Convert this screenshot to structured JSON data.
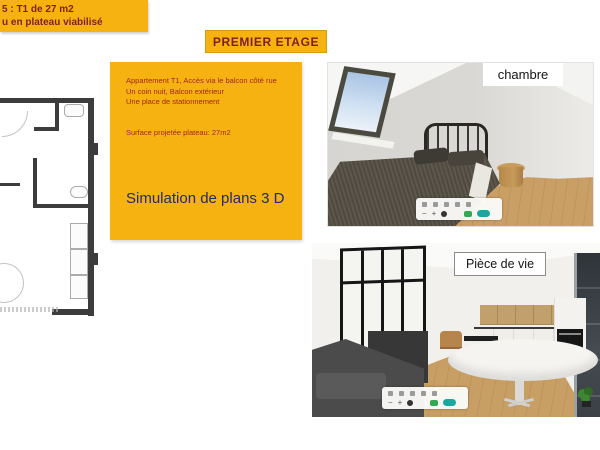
{
  "slide": {
    "lot_box": {
      "line1": "5 : T1 de 27 m2",
      "line2": "u en plateau viabilisé"
    },
    "floor_title": "PREMIER ETAGE",
    "description": {
      "lines": [
        "Appartement T1, Accès via le balcon côté rue",
        "Un coin nuit, Balcon extérieur",
        "Une place de stationnement"
      ],
      "surface": "Surface projetée plateau: 27m2",
      "simulation_title": "Simulation de plans 3 D"
    },
    "renders": {
      "bedroom_label": "chambre",
      "living_label": "Pièce de vie",
      "toolbar": {
        "zoom_out": "−",
        "zoom_in": "+"
      }
    },
    "colors": {
      "accent_yellow": "#F6B211",
      "heading_red": "#7E1F1F",
      "body_red": "#A3251C",
      "title_navy": "#232A6E",
      "toolbar_teal": "#19A89D",
      "toolbar_green": "#35A853",
      "wood_floor": "#C79E64",
      "plan_wall": "#3C3C3C"
    }
  }
}
